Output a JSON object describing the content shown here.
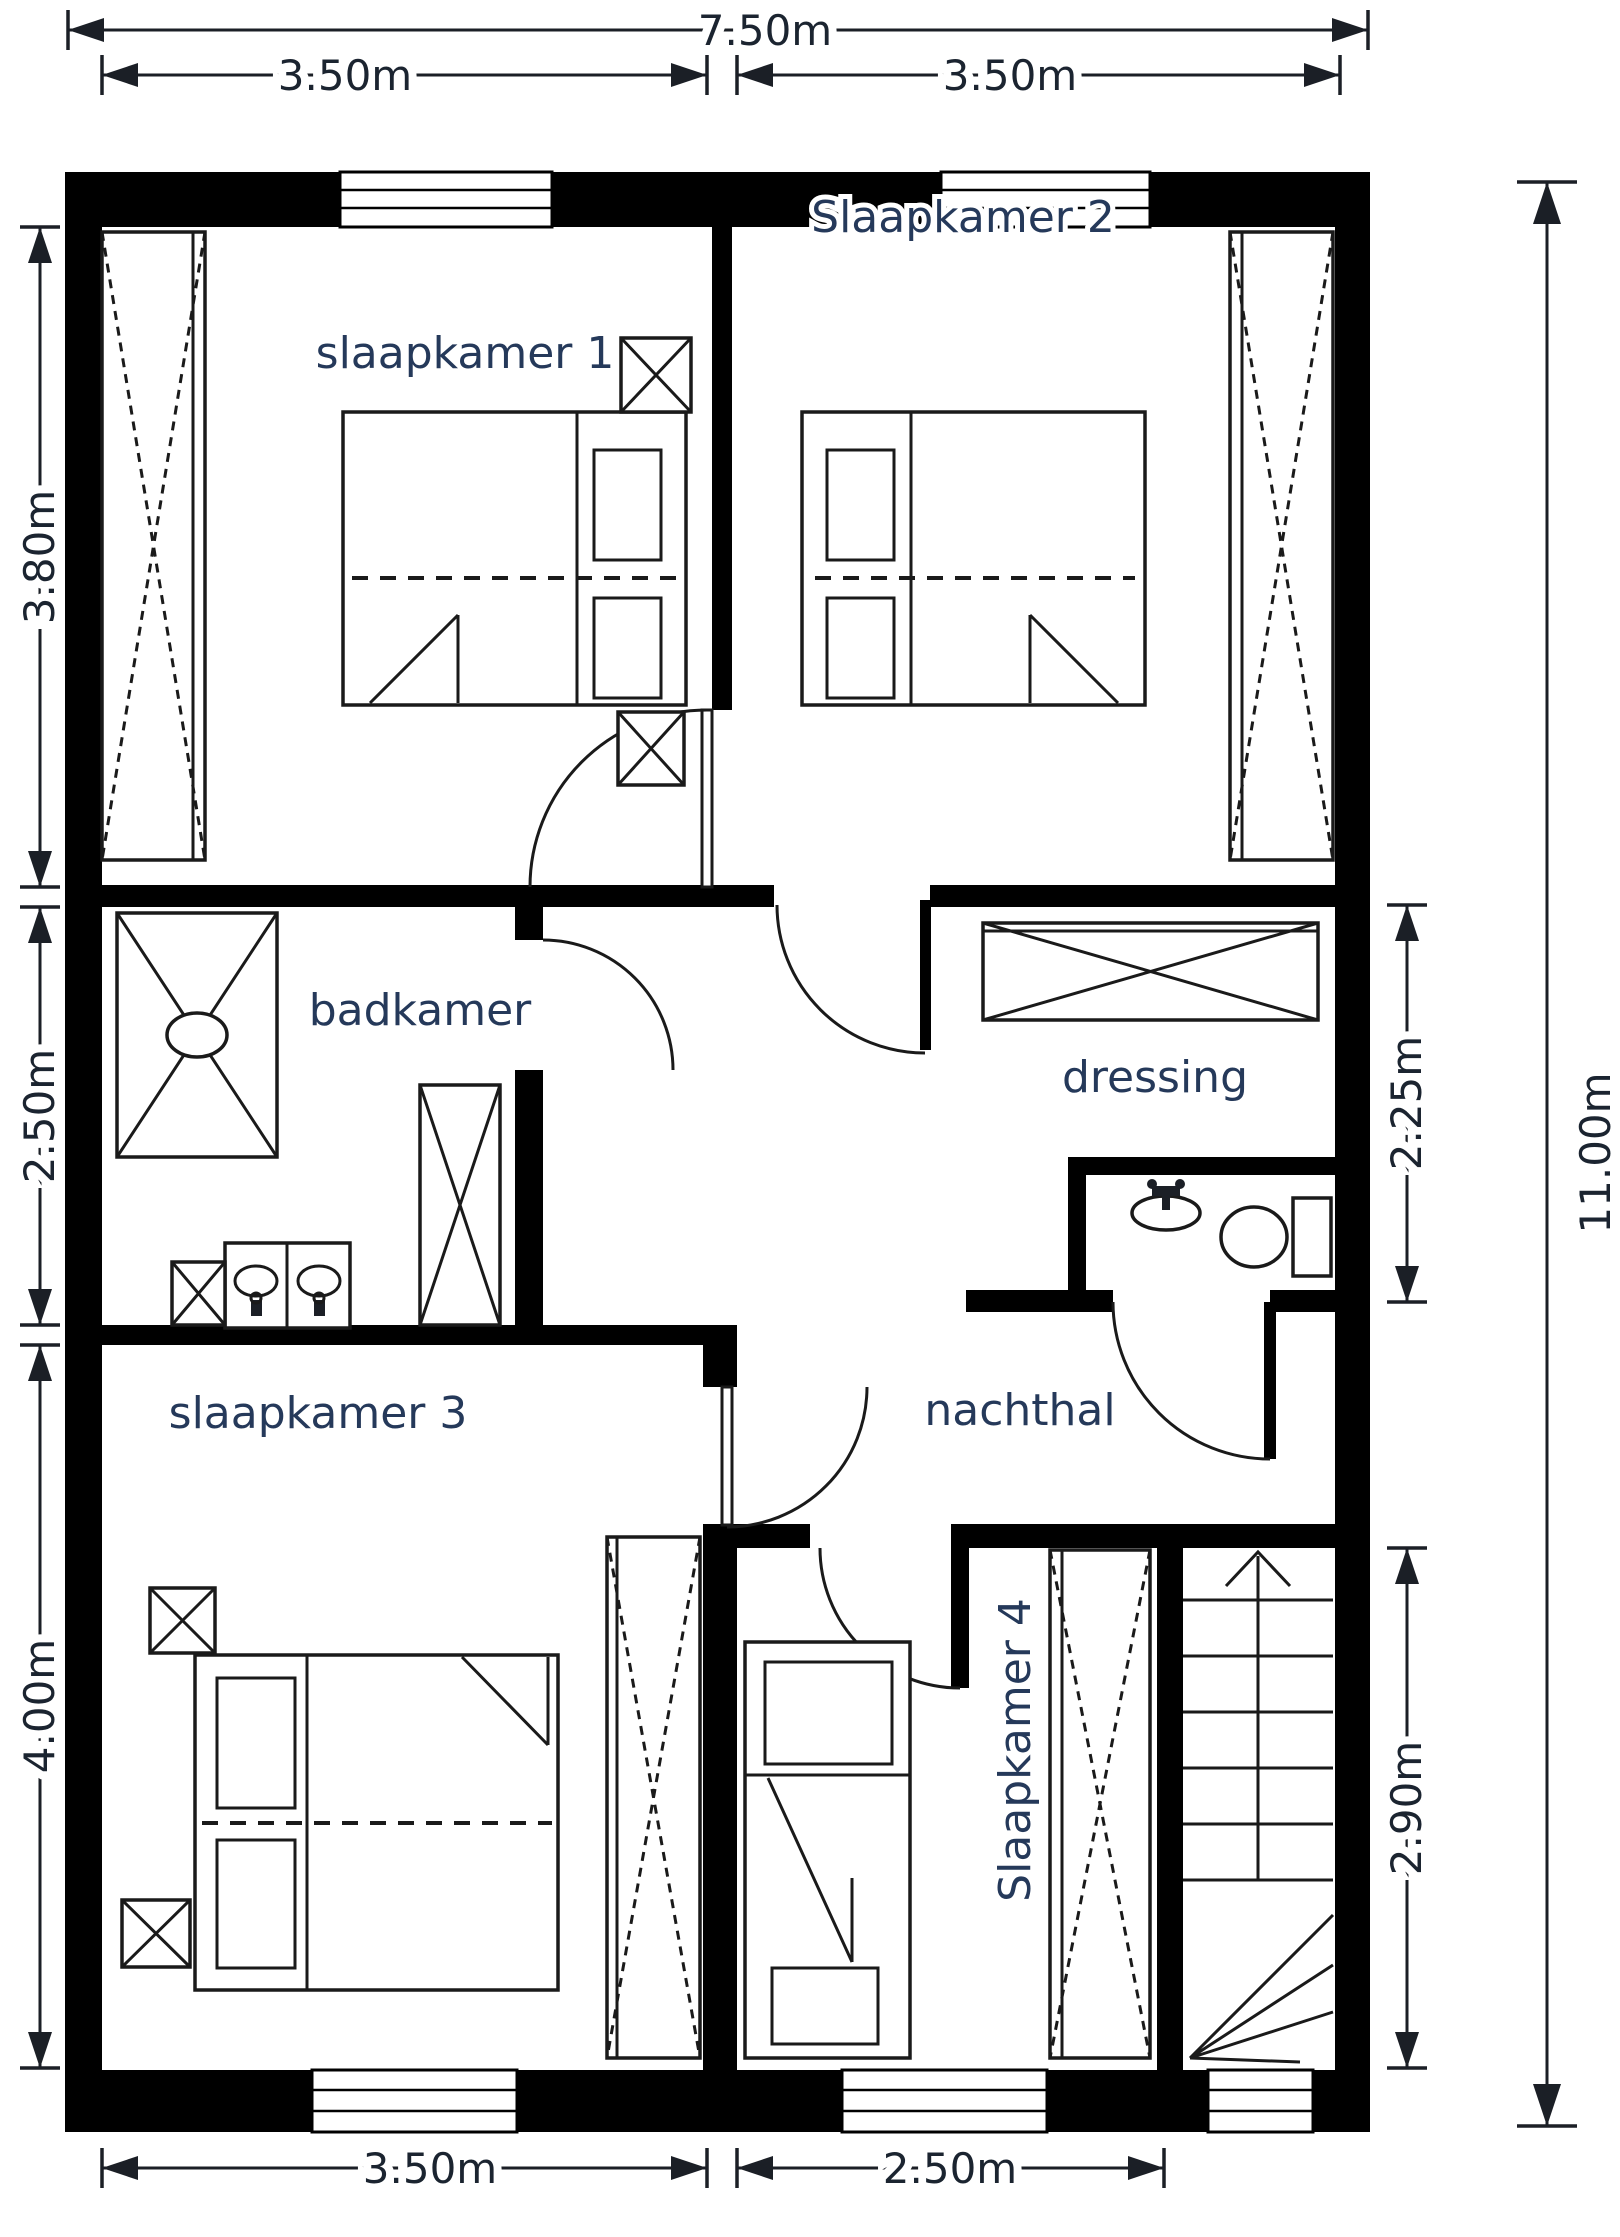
{
  "drawing": {
    "type": "floor-plan",
    "background_color": "#ffffff",
    "wall_color": "#000000",
    "line_color": "#1a1a1a",
    "room_label_color": "#25395a",
    "dimension_label_color": "#1b2430"
  },
  "rooms": {
    "slaapkamer1": "slaapkamer 1",
    "slaapkamer2": "Slaapkamer 2",
    "badkamer": "badkamer",
    "dressing": "dressing",
    "nachthal": "nachthal",
    "slaapkamer3": "slaapkamer 3",
    "slaapkamer4": "Slaapkamer 4"
  },
  "dims": {
    "top_total": "7.50m",
    "top_left": "3.50m",
    "top_right": "3.50m",
    "left_upper": "3.80m",
    "left_middle": "2.50m",
    "left_lower": "4.00m",
    "right_upper": "2.25m",
    "right_total": "11.00m",
    "right_lower": "2.90m",
    "bottom_left": "3.50m",
    "bottom_right": "2.50m"
  },
  "fixtures": {
    "wardrobe": "rectangle with crossed dashed diagonals",
    "nightstand": "small square with solid X",
    "double-bed": "rectangle with pillows, duvet fold and dashed centre line",
    "single-bed": "narrow rectangle with pillow and folded blanket",
    "shower": "rectangle with X and oval drain",
    "double-washbasin": "two squares with oval basins and taps",
    "bathroom-cabinet": "tall rectangle with solid X",
    "wc-sink": "oval basin with tap",
    "toilet": "bowl ellipse with cistern",
    "stairs": "treads with winders and up arrow",
    "door": "quarter-circle swing arc with leaf",
    "window": "white wall opening with triple line"
  }
}
